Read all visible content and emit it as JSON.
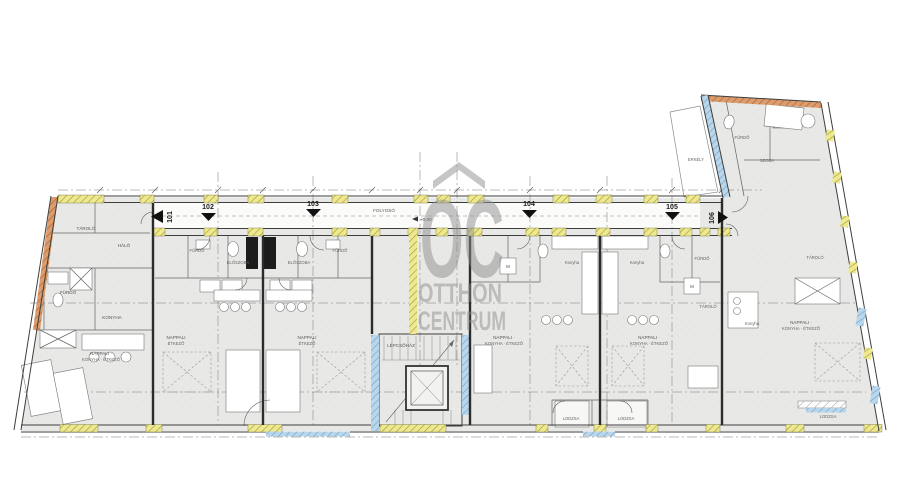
{
  "watermark": {
    "brand": "OC",
    "name_line1": "OTTHON",
    "name_line2": "CENTRUM",
    "color": "#9a9a9a"
  },
  "units": [
    {
      "id": "101",
      "marker": "left"
    },
    {
      "id": "102",
      "marker": "down"
    },
    {
      "id": "103",
      "marker": "down"
    },
    {
      "id": "104",
      "marker": "down"
    },
    {
      "id": "105",
      "marker": "down"
    },
    {
      "id": "106",
      "marker": "right"
    }
  ],
  "annotations": {
    "level_mark": "+0.00"
  },
  "rooms": [
    {
      "label": "TÁROLÓ"
    },
    {
      "label": "HÁLÓ"
    },
    {
      "label": "FÜRDŐ"
    },
    {
      "label": "KONYHA"
    },
    {
      "label": "NAPPALI ·"
    },
    {
      "label": "KONYHA · ÉTKEZŐ"
    },
    {
      "label": "FÜRDŐ"
    },
    {
      "label": "ELŐSZOBA"
    },
    {
      "label": "ELŐSZOBA"
    },
    {
      "label": "FÜRDŐ"
    },
    {
      "label": "NAPPALI"
    },
    {
      "label": "ÉTKEZŐ"
    },
    {
      "label": "NAPPALI"
    },
    {
      "label": "ÉTKEZŐ"
    },
    {
      "label": "FOLYOSÓ"
    },
    {
      "label": "LÉPCSŐHÁZ"
    },
    {
      "label": "Konyha"
    },
    {
      "label": "Konyha"
    },
    {
      "label": "NAPPALI ·"
    },
    {
      "label": "KONYHA · ÉTKEZŐ"
    },
    {
      "label": "NAPPALI ·"
    },
    {
      "label": "KONYHA · ÉTKEZŐ"
    },
    {
      "label": "FÜRDŐ"
    },
    {
      "label": "TÁROLÓ"
    },
    {
      "label": "M"
    },
    {
      "label": "M"
    },
    {
      "label": "LODZSA"
    },
    {
      "label": "LODZSA"
    },
    {
      "label": "ERKÉLY"
    },
    {
      "label": "FÜRDŐ"
    },
    {
      "label": "SZOBA"
    },
    {
      "label": "TÁROLÓ"
    },
    {
      "label": "Konyha"
    },
    {
      "label": "NAPPALI ·"
    },
    {
      "label": "KONYHA · ÉTKEZŐ"
    },
    {
      "label": "LODZSA"
    }
  ],
  "colors": {
    "room_fill": "#e8e8e6",
    "wall_line": "#3e3e3e",
    "hatch_yellow": "#eee98e",
    "hatch_orange": "#dc9c6e",
    "hatch_blue": "#b9d6ea",
    "watermark_gray": "#9a9a9a"
  }
}
